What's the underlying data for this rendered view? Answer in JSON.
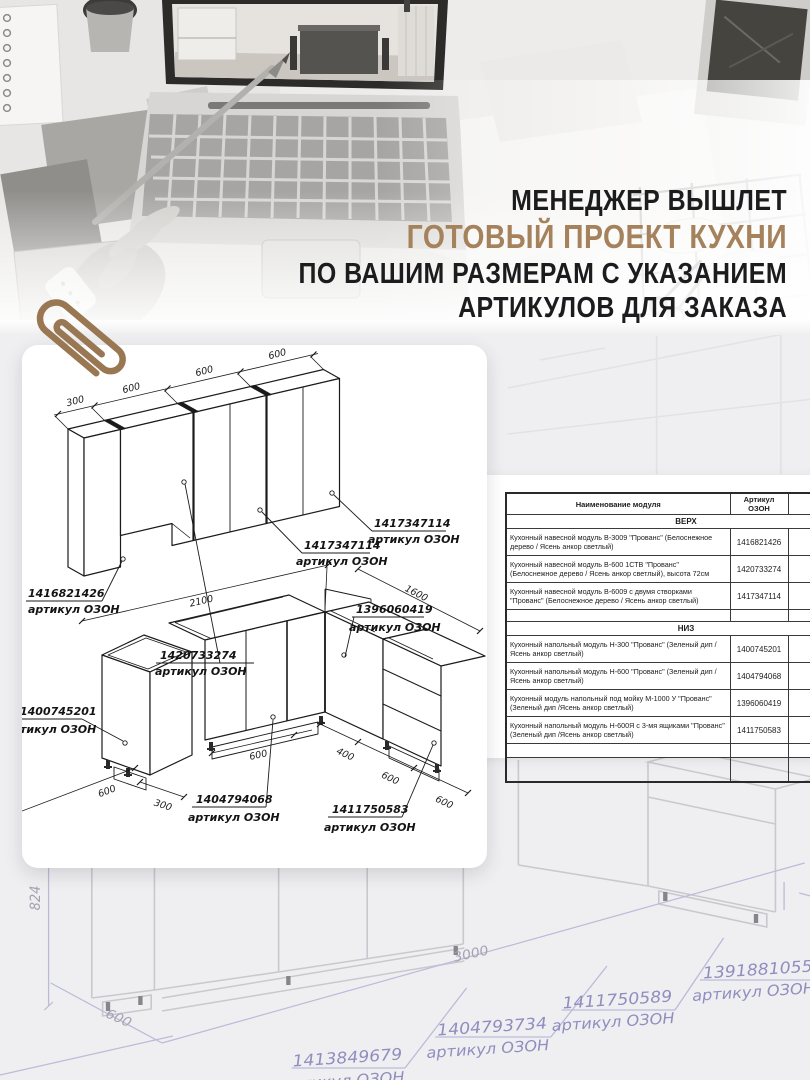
{
  "header": {
    "line1": "МЕНЕДЖЕР ВЫШЛЕТ",
    "line2": "ГОТОВЫЙ ПРОЕКТ КУХНИ",
    "line3": "ПО ВАШИМ РАЗМЕРАМ С УКАЗАНИЕМ",
    "line4": "АРТИКУЛОВ ДЛЯ ЗАКАЗА",
    "accent_color": "#a5825c",
    "text_color": "#1c1c1e"
  },
  "card": {
    "upper": {
      "dims": [
        "300",
        "600",
        "600",
        "600"
      ],
      "callouts": [
        {
          "article": "1416821426",
          "label": "артикул ОЗОН"
        },
        {
          "article": "1420733274",
          "label": "артикул ОЗОН"
        },
        {
          "article": "1417347114",
          "label": "артикул ОЗОН"
        },
        {
          "article": "1417347114",
          "label": "артикул ОЗОН"
        }
      ]
    },
    "lower": {
      "dim_left_run": "2100",
      "dim_right_run": "1600",
      "small_cab_dims": [
        "600",
        "300"
      ],
      "bottom_dims": [
        "600",
        "400",
        "600",
        "600"
      ],
      "callouts": [
        {
          "article": "1400745201",
          "label": "тикул ОЗОН"
        },
        {
          "article": "1396060419",
          "label": "артикул ОЗОН"
        },
        {
          "article": "1404794068",
          "label": "артикул ОЗОН"
        },
        {
          "article": "1411750583",
          "label": "артикул ОЗОН"
        }
      ]
    }
  },
  "table": {
    "col_headers": [
      "Наименование модуля",
      "Артикул ОЗОН",
      "Кол-во"
    ],
    "sections": [
      {
        "title": "ВЕРХ",
        "rows": [
          {
            "name": "Кухонный навесной модуль В-3009 \"Прованс\" (Белоснежное дерево / Ясень анкор светлый)",
            "article": "1416821426"
          },
          {
            "name": "Кухонный навесной модуль В-600 1СТВ \"Прованс\" (Белоснежное дерево / Ясень анкор светлый), высота 72см",
            "article": "1420733274"
          },
          {
            "name": "Кухонный навесной модуль В-6009 с двумя створками \"Прованс\" (Белоснежное дерево / Ясень анкор светлый)",
            "article": "1417347114"
          }
        ]
      },
      {
        "title": "НИЗ",
        "rows": [
          {
            "name": "Кухонный напольный модуль Н-300 \"Прованс\" (Зеленый дип /Ясень анкор светлый)",
            "article": "1400745201"
          },
          {
            "name": "Кухонный напольный модуль Н-600 \"Прованс\" (Зеленый дип /Ясень анкор светлый)",
            "article": "1404794068"
          },
          {
            "name": "Кухонный модуль напольный под мойку М-1000 У \"Прованс\" (Зеленый дип /Ясень анкор светлый)",
            "article": "1396060419"
          },
          {
            "name": "Кухонный напольный модуль Н-600Я с 3-мя ящиками \"Прованс\" (Зеленый дип /Ясень анкор светлый)",
            "article": "1411750583"
          }
        ]
      }
    ]
  },
  "sketch": {
    "dims": [
      "824",
      "600",
      "3000",
      "700"
    ],
    "callouts": [
      {
        "article": "1413849679",
        "label": "артикул ОЗОН"
      },
      {
        "article": "1404793734",
        "label": "артикул ОЗОН"
      },
      {
        "article": "1411750589",
        "label": "артикул ОЗОН"
      },
      {
        "article": "1391881055",
        "label": "артикул ОЗОН"
      }
    ],
    "line_color": "#c9c8ce",
    "dim_color": "#a3a2b2",
    "article_color": "#908dbf"
  }
}
